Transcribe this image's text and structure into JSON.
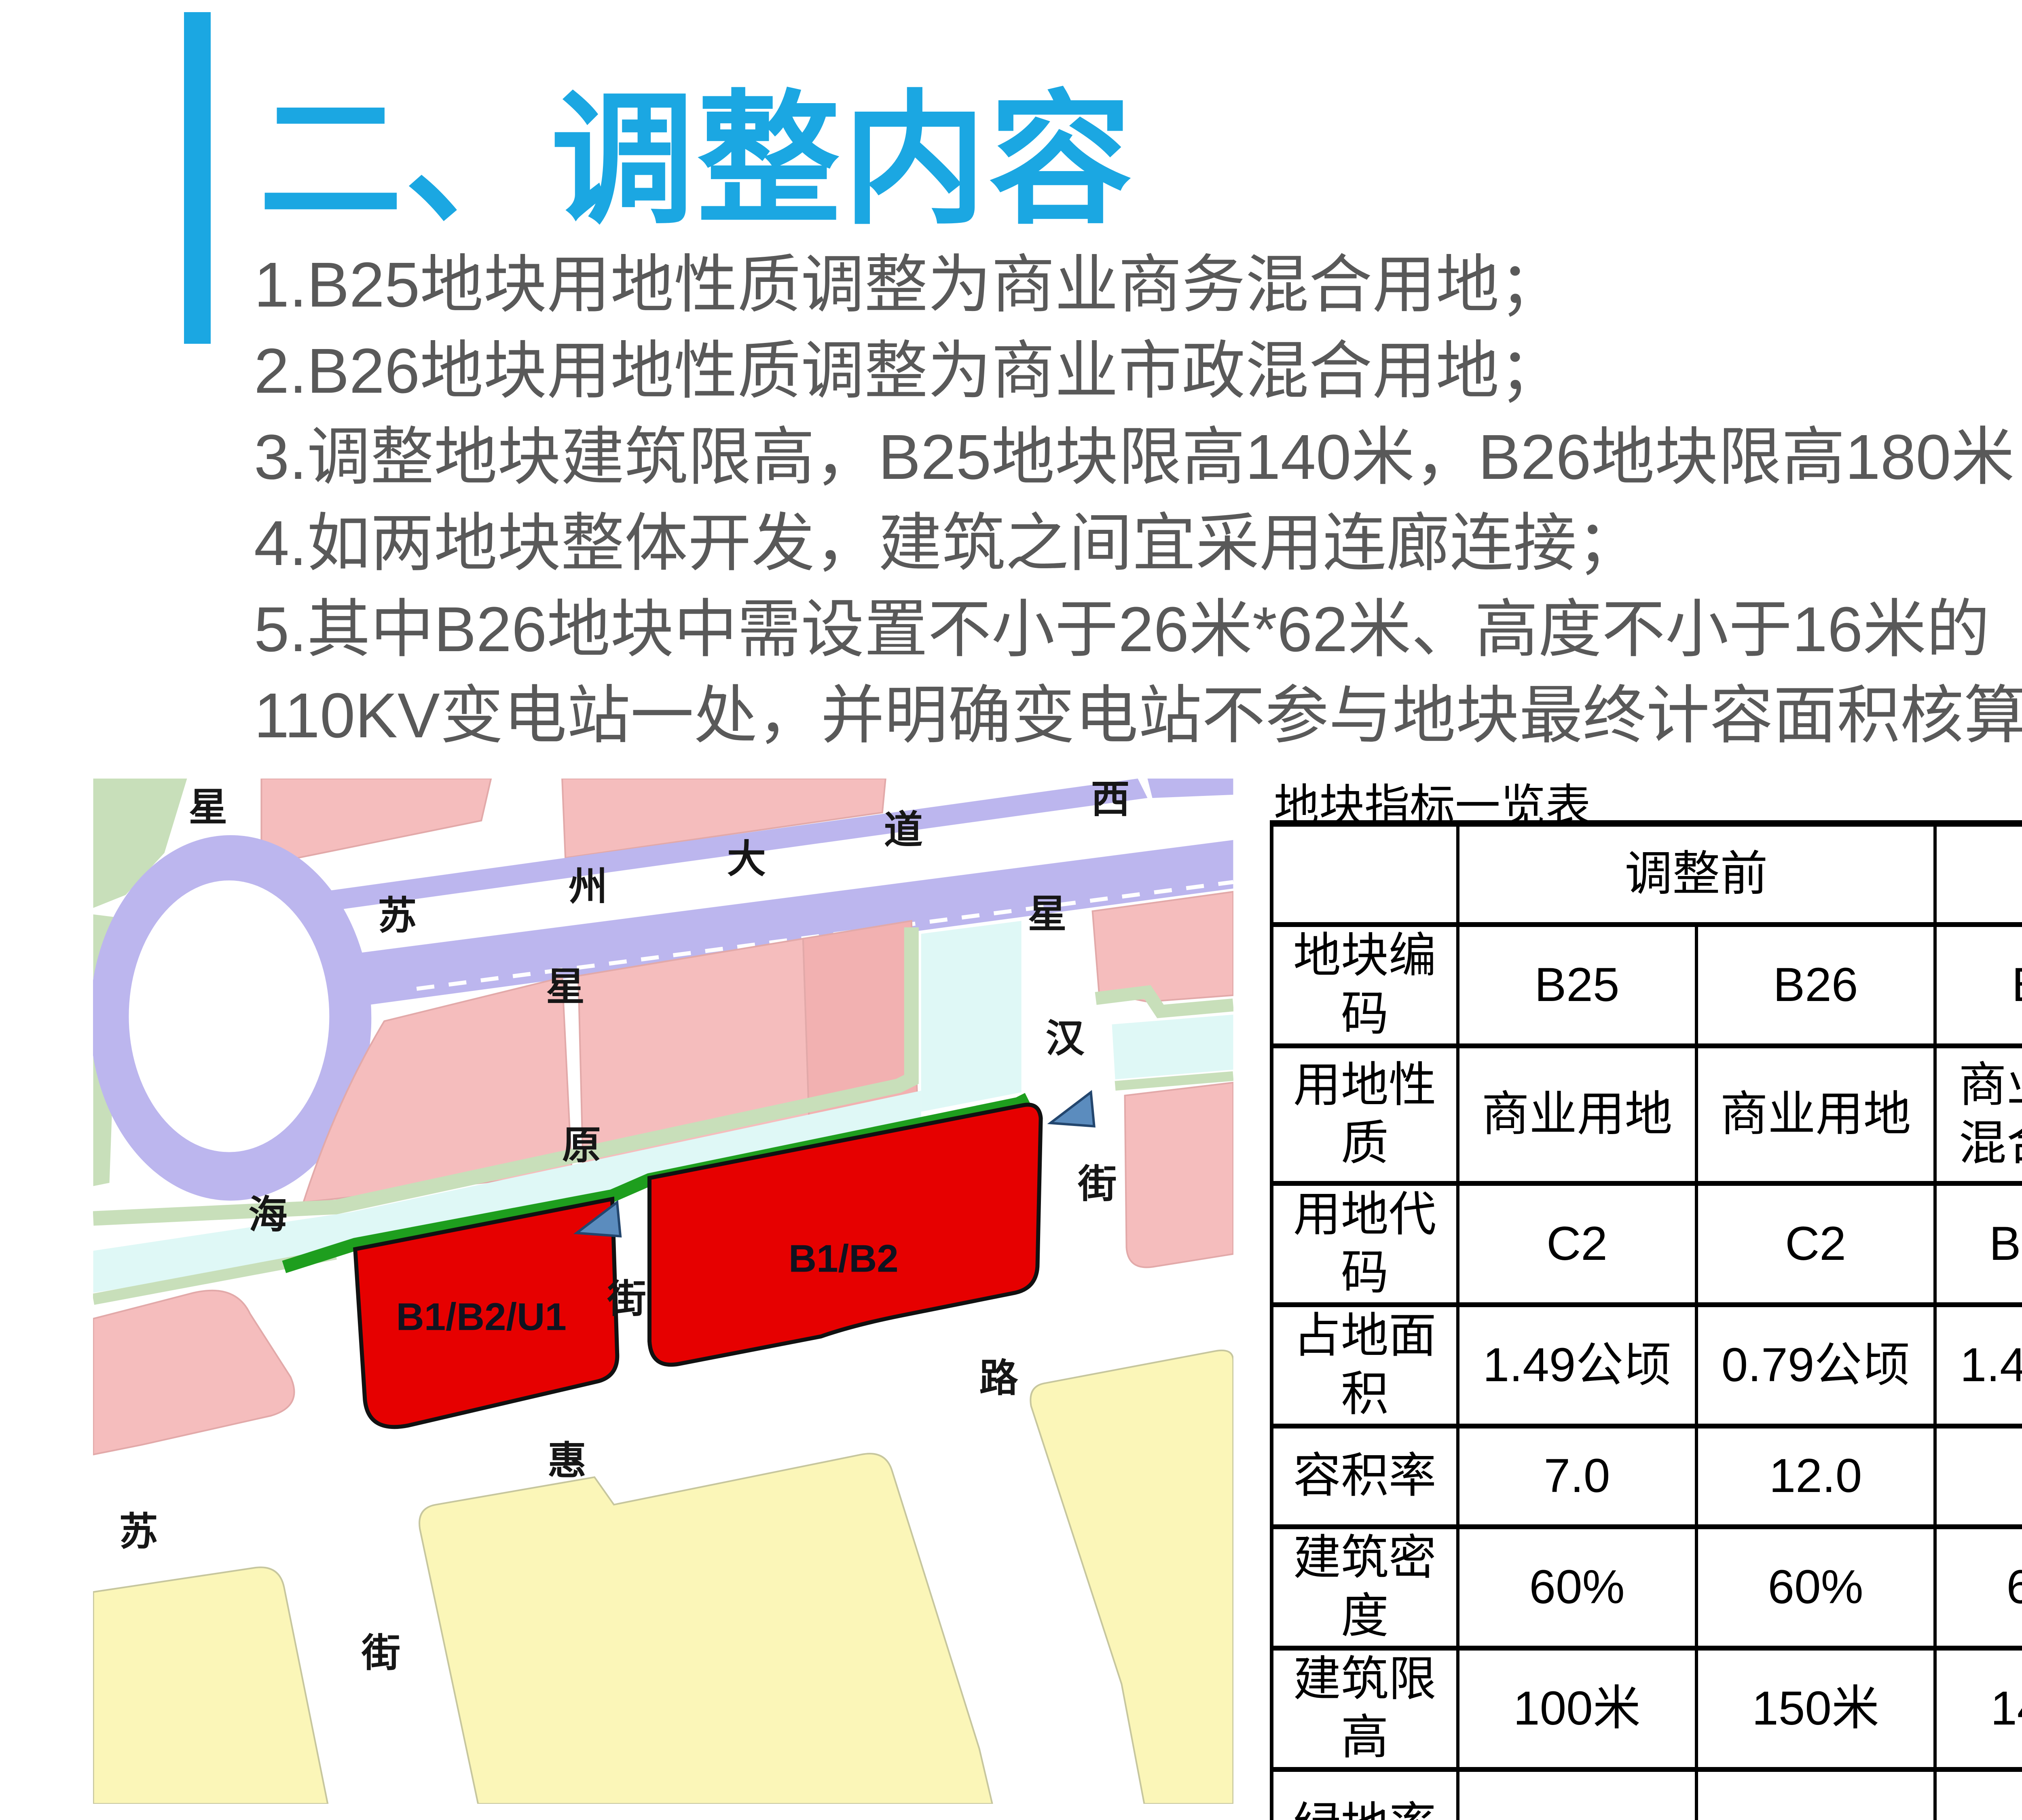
{
  "slide": {
    "title": "二、调整内容"
  },
  "notes": [
    "1.B25地块用地性质调整为商业商务混合用地；",
    "2.B26地块用地性质调整为商业市政混合用地；",
    "3.调整地块建筑限高，B25地块限高140米，B26地块限高180米；",
    "4.如两地块整体开发，建筑之间宜采用连廊连接；",
    "5.其中B26地块中需设置不小于26米*62米、高度不小于16米的",
    "110KV变电站一处，并明确变电站不参与地块最终计容面积核算。"
  ],
  "map": {
    "parcels": [
      {
        "label": "B1/B2/U1"
      },
      {
        "label": "B1/B2"
      }
    ],
    "streets": {
      "suzhou_avenue": [
        "苏",
        "州",
        "大",
        "道",
        "西"
      ],
      "xinghai_street": [
        "星",
        "海",
        "街"
      ],
      "xingyuan_street": [
        "星",
        "原",
        "街"
      ],
      "xinghan_street": [
        "星",
        "汉",
        "街"
      ],
      "suhui_road": [
        "苏",
        "惠",
        "路"
      ]
    }
  },
  "table": {
    "title": "地块指标一览表",
    "groups": {
      "before": "调整前",
      "after": "调整后"
    },
    "rows": [
      {
        "label": "地块编码",
        "cells": [
          "B25",
          "B26",
          "B25",
          "B26"
        ]
      },
      {
        "label": "用地性质",
        "cells": [
          "商业用地",
          "商业用地",
          "商业商务\n混合用地",
          "商业市政\n混合用地"
        ]
      },
      {
        "label": "用地代码",
        "cells": [
          "C2",
          "C2",
          "B1/B2",
          "B1/B2/U1"
        ]
      },
      {
        "label": "占地面积",
        "cells": [
          "1.49公顷",
          "0.79公顷",
          "1.49公顷",
          "0.79公顷"
        ]
      },
      {
        "label": "容积率",
        "cells": [
          "7.0",
          "12.0",
          "7.0",
          "12.0"
        ]
      },
      {
        "label": "建筑密度",
        "cells": [
          "60%",
          "60%",
          "60%",
          "60%"
        ]
      },
      {
        "label": "建筑限高",
        "cells": [
          "100米",
          "150米",
          "140米",
          "180米"
        ]
      },
      {
        "label": "绿地率",
        "cells": [
          "——",
          "——",
          "——",
          "——"
        ]
      }
    ]
  },
  "colors": {
    "accent_blue": "#1BA7E2",
    "note_gray": "#595959",
    "table_changed_red": "#FF0000",
    "parcel_red": "#E60000",
    "road_lavender": "#BCB6EE",
    "block_pink": "#F5BDBD",
    "block_pink_dark": "#F2B1B1",
    "block_yellow": "#FBF6B8",
    "canal_cyan": "#DFF8F6",
    "green_strip": "#1E9E1E",
    "sage_green": "#C8DFBA",
    "arrow_blue": "#5B8CBE"
  }
}
